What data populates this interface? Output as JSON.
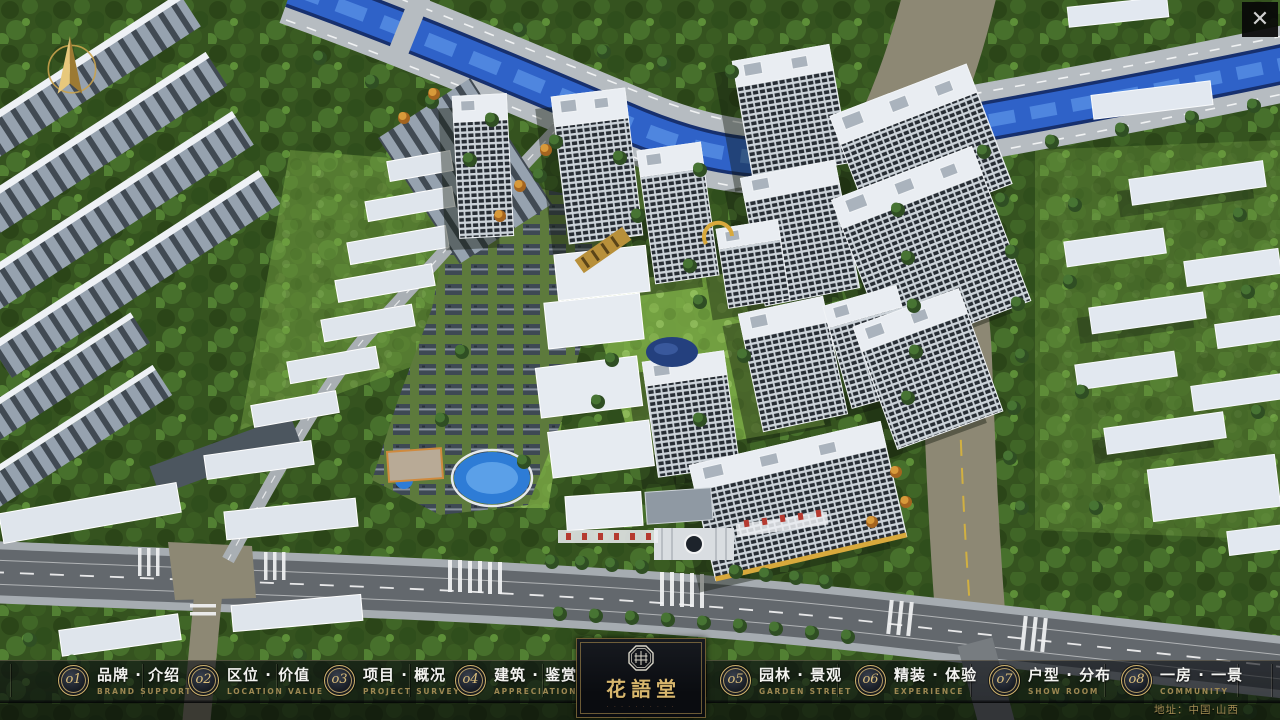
{
  "window": {
    "close_glyph": "✕"
  },
  "nav": {
    "items": [
      {
        "number": "o1",
        "label_zh": "品牌 · 介绍",
        "label_en": "BRAND SUPPORT"
      },
      {
        "number": "o2",
        "label_zh": "区位 · 价值",
        "label_en": "LOCATION VALUE"
      },
      {
        "number": "o3",
        "label_zh": "项目 · 概况",
        "label_en": "PROJECT SURVEY"
      },
      {
        "number": "o4",
        "label_zh": "建筑 · 鉴赏",
        "label_en": "APPRECIATION"
      },
      {
        "number": "o5",
        "label_zh": "园林 · 景观",
        "label_en": "GARDEN STREET"
      },
      {
        "number": "o6",
        "label_zh": "精装 · 体验",
        "label_en": "EXPERIENCE"
      },
      {
        "number": "o7",
        "label_zh": "户型 · 分布",
        "label_en": "SHOW ROOM"
      },
      {
        "number": "o8",
        "label_zh": "一房 · 一景",
        "label_en": "COMMUNITY"
      }
    ]
  },
  "logo": {
    "title": "花語堂",
    "tagline": "· · · · · · · · · ·"
  },
  "footer": {
    "address": "地址：中国·山西"
  },
  "colors": {
    "gold": "#cdb06b",
    "bar_bg": "rgba(10,13,18,0.62)",
    "river": "#2f62c8",
    "label": "#f3f3f0"
  }
}
